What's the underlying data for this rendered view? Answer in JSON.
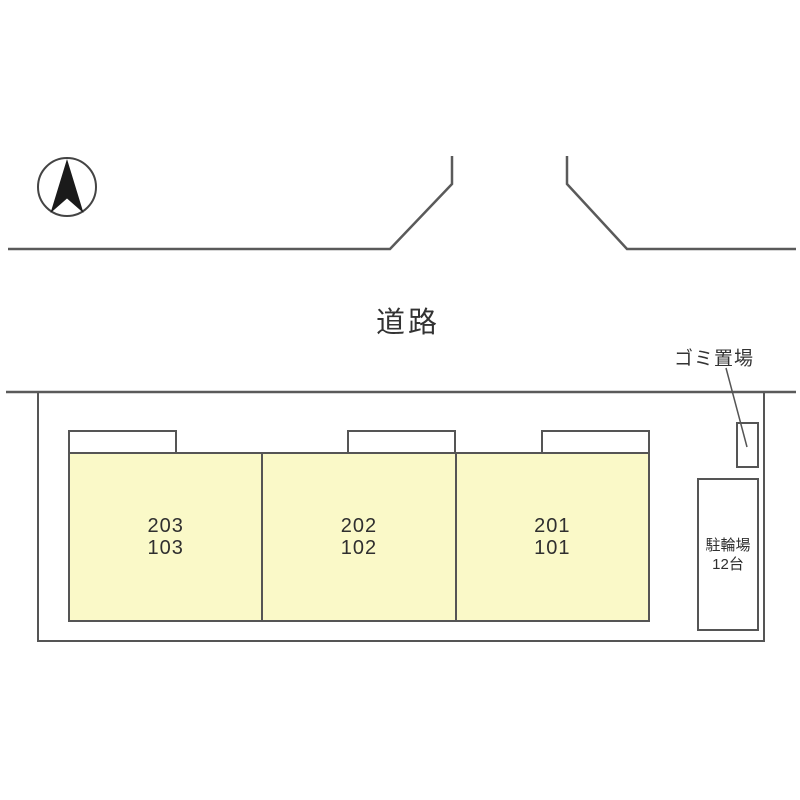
{
  "site_plan": {
    "compass": {
      "icon": "north-arrow"
    },
    "road": {
      "label": "道路"
    },
    "garbage_area": {
      "label": "ゴミ置場"
    },
    "bike_parking": {
      "name": "駐輪場",
      "capacity": "12台"
    },
    "building": {
      "units": [
        {
          "upper": "203",
          "lower": "103"
        },
        {
          "upper": "202",
          "lower": "102"
        },
        {
          "upper": "201",
          "lower": "101"
        }
      ]
    },
    "colors": {
      "building_fill": "#faf9c8",
      "line": "#555555",
      "text": "#333333",
      "arrow": "#1a1a1a"
    }
  }
}
